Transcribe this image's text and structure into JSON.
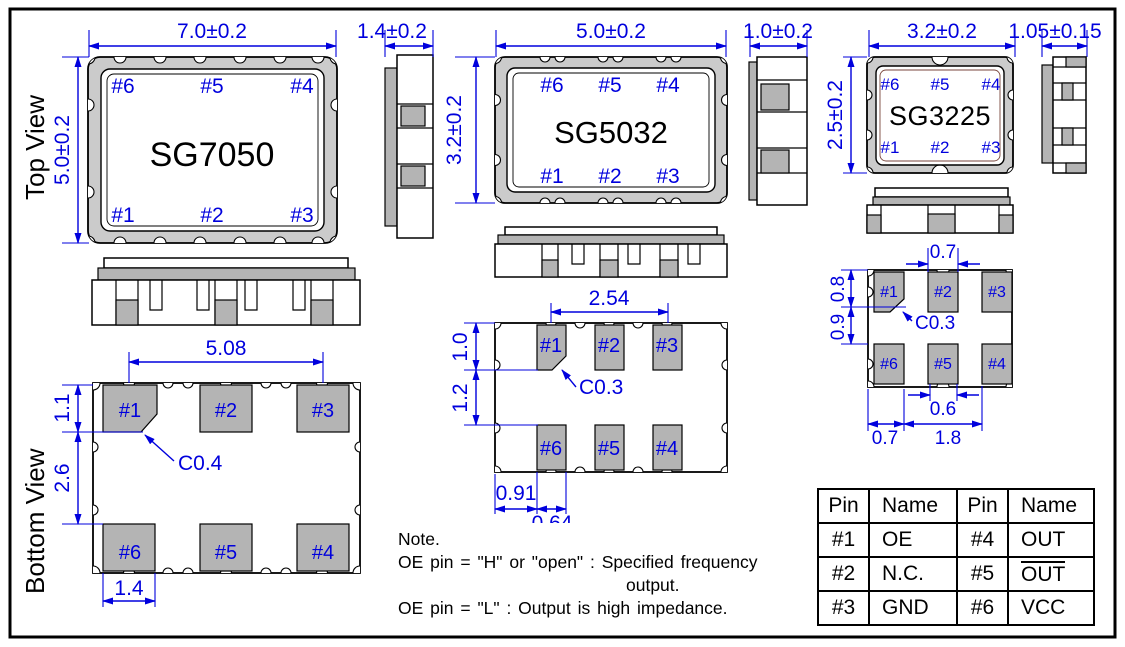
{
  "labels": {
    "top_view": "Top View",
    "bottom_view": "Bottom View"
  },
  "colors": {
    "dim_blue": "#0000dd",
    "pad_gray": "#b4b4b4",
    "ring_gray": "#cbcbcb"
  },
  "p7050": {
    "name": "SG7050",
    "pins_top": [
      "#6",
      "#5",
      "#4"
    ],
    "pins_bottom": [
      "#1",
      "#2",
      "#3"
    ],
    "dim_w": "7.0±0.2",
    "dim_h": "5.0±0.2",
    "dim_t": "1.4±0.2",
    "pads_top": [
      "#1",
      "#2",
      "#3"
    ],
    "pads_bottom": [
      "#6",
      "#5",
      "#4"
    ],
    "dim_pitch": "5.08",
    "dim_pad_len": "1.1",
    "dim_gap": "2.6",
    "dim_pad_w": "1.4",
    "chamfer": "C0.4"
  },
  "p5032": {
    "name": "SG5032",
    "pins_top": [
      "#6",
      "#5",
      "#4"
    ],
    "pins_bottom": [
      "#1",
      "#2",
      "#3"
    ],
    "dim_w": "5.0±0.2",
    "dim_h": "3.2±0.2",
    "dim_t": "1.0±0.2",
    "pads_top": [
      "#1",
      "#2",
      "#3"
    ],
    "pads_bottom": [
      "#6",
      "#5",
      "#4"
    ],
    "dim_pitch": "2.54",
    "dim_pad_len": "1.0",
    "dim_gap": "1.2",
    "dim_edge": "0.91",
    "dim_pad_w": "0.64",
    "chamfer": "C0.3"
  },
  "p3225": {
    "name": "SG3225",
    "pins_top": [
      "#6",
      "#5",
      "#4"
    ],
    "pins_bottom": [
      "#1",
      "#2",
      "#3"
    ],
    "dim_w": "3.2±0.2",
    "dim_h": "2.5±0.2",
    "dim_t": "1.05±0.15",
    "pads_top": [
      "#1",
      "#2",
      "#3"
    ],
    "pads_bottom": [
      "#6",
      "#5",
      "#4"
    ],
    "dim_pad_w_top": "0.7",
    "dim_pad_len": "0.8",
    "dim_gap": "0.9",
    "dim_notch": "0.6",
    "dim_edge": "0.7",
    "dim_span": "1.8",
    "chamfer": "C0.3"
  },
  "note": {
    "title": "Note.",
    "line1": "OE pin = \"H\" or \"open\" : Specified frequency",
    "line2": "output.",
    "line3": "OE pin = \"L\" : Output is high impedance."
  },
  "pin_table": {
    "headers": [
      "Pin",
      "Name",
      "Pin",
      "Name"
    ],
    "rows": [
      [
        "#1",
        "OE",
        "#4",
        "OUT"
      ],
      [
        "#2",
        "N.C.",
        "#5",
        "OUT"
      ],
      [
        "#3",
        "GND",
        "#6",
        "VCC"
      ]
    ]
  }
}
